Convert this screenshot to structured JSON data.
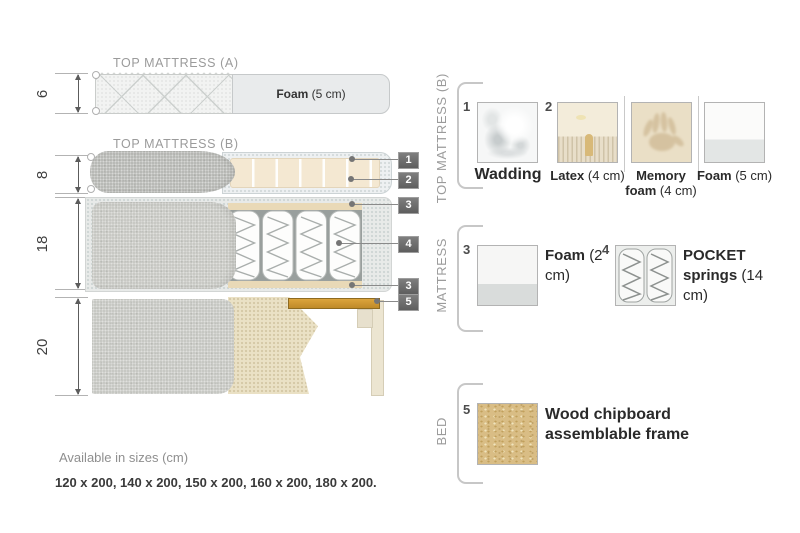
{
  "diagram": {
    "top_mattress_a": {
      "title": "TOP MATTRESS (A)",
      "height_cm": "6",
      "foam_bold": "Foam",
      "foam_rest": " (5 cm)"
    },
    "top_mattress_b": {
      "title": "TOP MATTRESS (B)",
      "height_cm": "8"
    },
    "mattress": {
      "height_cm": "18"
    },
    "bed": {
      "height_cm": "20"
    },
    "callouts": [
      "1",
      "2",
      "3",
      "4",
      "3",
      "5"
    ]
  },
  "legend": {
    "sections": [
      {
        "name": "TOP MATTRESS (B)",
        "items": [
          {
            "num": "1",
            "bold": "Wadding",
            "rest": ""
          },
          {
            "num": "2",
            "bold": "Latex",
            "rest": " (4 cm)"
          },
          {
            "num": "",
            "bold": "Memory foam",
            "rest": " (4 cm)"
          },
          {
            "num": "",
            "bold": "Foam",
            "rest": " (5 cm)"
          }
        ]
      },
      {
        "name": "MATTRESS",
        "items": [
          {
            "num": "3",
            "bold": "Foam",
            "rest": "(2 cm)"
          },
          {
            "num": "4",
            "bold": "POCKET springs",
            "rest": "(14 cm)"
          }
        ]
      },
      {
        "name": "BED",
        "items": [
          {
            "num": "5",
            "bold": "Wood chipboard assemblable frame",
            "rest": ""
          }
        ]
      }
    ]
  },
  "footer": {
    "availability": "Available in sizes (cm)",
    "sizes": "120 x 200, 140 x 200, 150 x 200, 160 x 200, 180 x 200."
  },
  "colors": {
    "wood": "#cf9a36",
    "foam_cream": "#f4e8d2",
    "fabric_gray": "#c6c7c2",
    "label_bg": "#6b6b6b"
  }
}
